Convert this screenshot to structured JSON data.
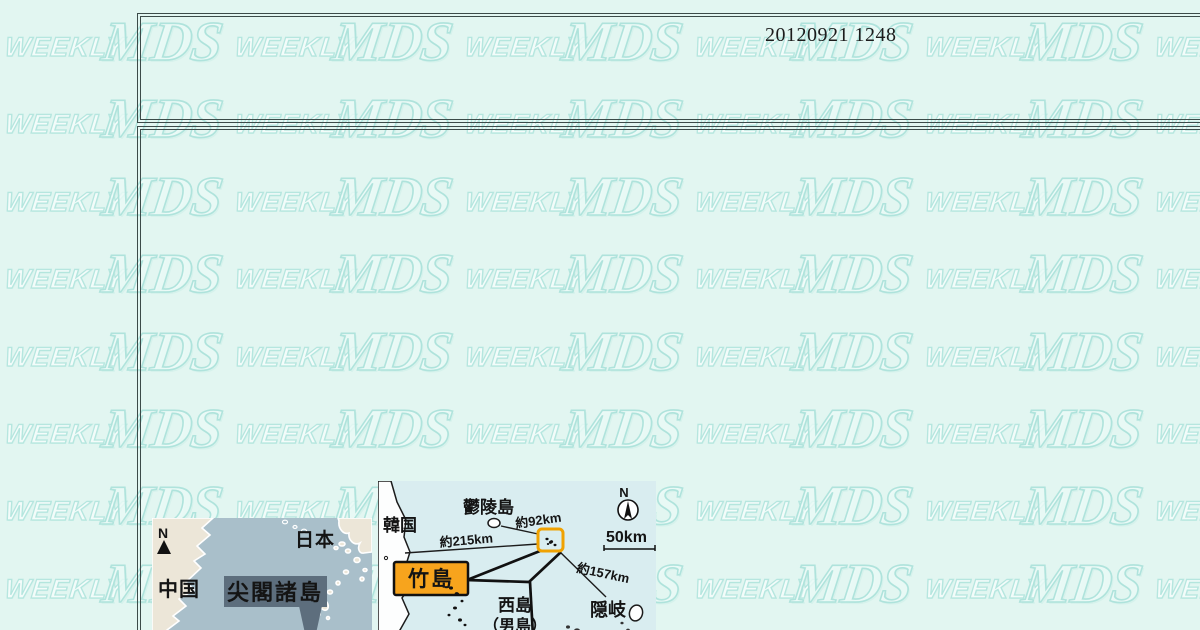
{
  "page": {
    "background_color": "#e2f6f1",
    "frame_border_color": "#3c4b49"
  },
  "header": {
    "timestamp": "20120921 1248"
  },
  "watermark": {
    "word1": "WEEKLY",
    "word2": "MDS"
  },
  "map_senkaku": {
    "compass_label": "N",
    "labels": {
      "japan": "日本",
      "china": "中国",
      "callout": "尖閣諸島"
    },
    "colors": {
      "sea": "#a9bfca",
      "land": "#ece6d8",
      "coastline": "#ffffff",
      "callout_bg": "#5d6e7d",
      "callout_text": "#ffffff"
    }
  },
  "map_takeshima": {
    "compass_label": "N",
    "scale_label": "50km",
    "labels": {
      "korea": "韓国",
      "ulleungdo": "鬱陵島",
      "distance_ulleungdo": "約92km",
      "distance_korea": "約215km",
      "distance_oki": "約157km",
      "takeshima": "竹島",
      "nishijima_line1": "西島",
      "nishijima_line2": "（男島）",
      "oki": "隠岐"
    },
    "colors": {
      "sea": "#d9edf0",
      "land": "#fdfefe",
      "outline": "#1c1c1c",
      "highlight_box": "#f0a202",
      "takeshima_label_bg": "#f7a41d",
      "takeshima_label_text": "#ffffff"
    }
  }
}
